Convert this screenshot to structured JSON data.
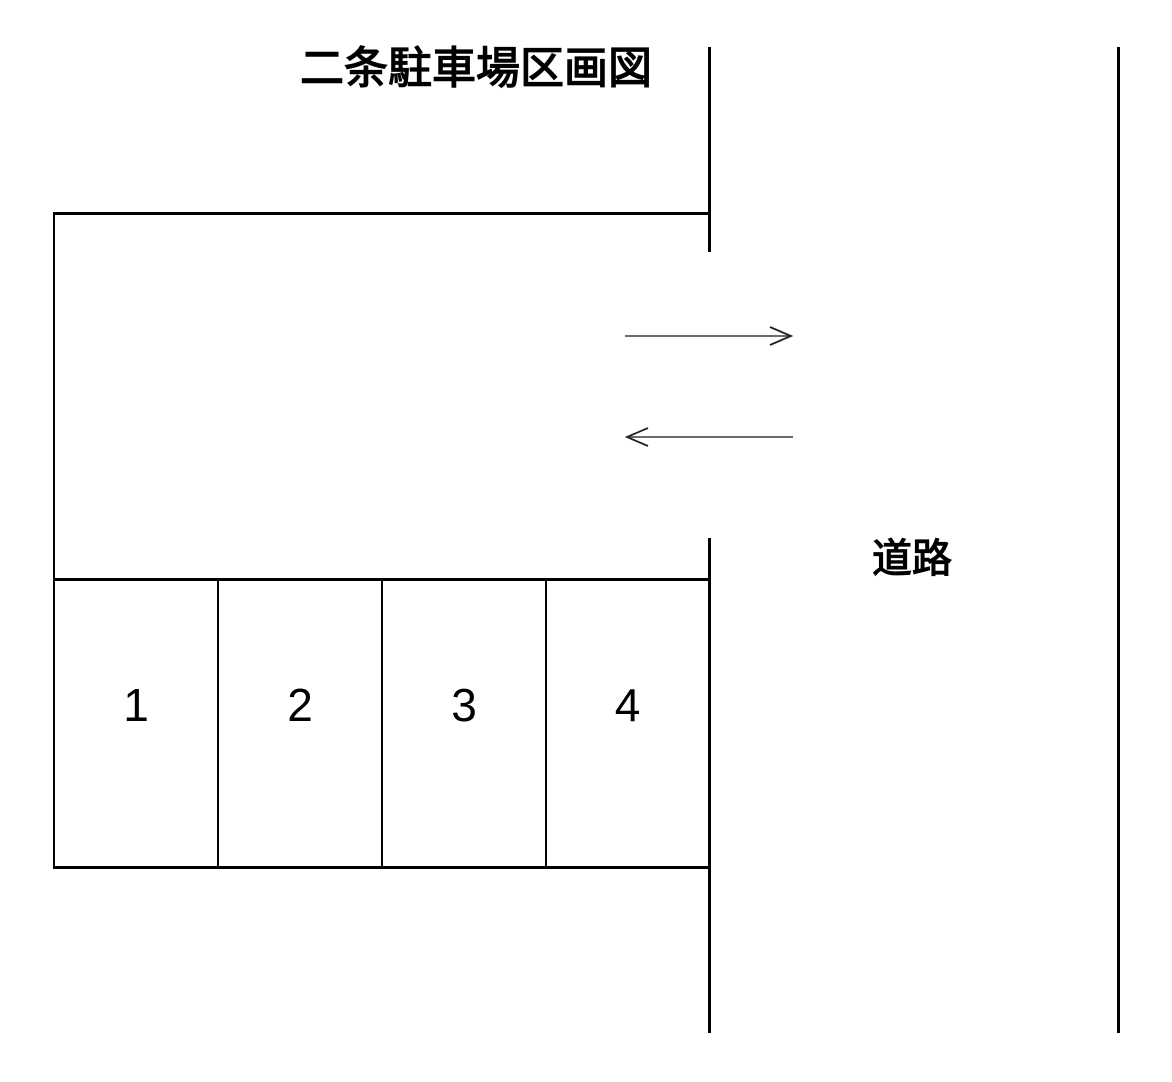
{
  "title": "二条駐車場区画図",
  "road": {
    "label": "道路"
  },
  "parking": {
    "spaces": [
      {
        "label": "1"
      },
      {
        "label": "2"
      },
      {
        "label": "3"
      },
      {
        "label": "4"
      }
    ]
  },
  "arrows": {
    "in_direction": "right",
    "out_direction": "left"
  },
  "colors": {
    "background": "#ffffff",
    "line": "#000000",
    "arrow": "#3a3a3a",
    "text": "#000000"
  }
}
